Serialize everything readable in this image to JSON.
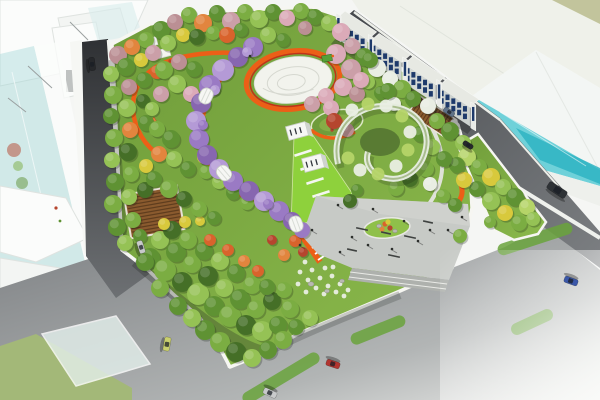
{
  "scene": {
    "type": "aerial-architectural-rendering",
    "subject": "bird's-eye view of an urban pocket-park landscape masterplan with orange loop paths, wisteria tunnel, circular plaza, surrounded by roads and ghost buildings"
  },
  "palette": {
    "bg": "#f5f6f4",
    "ghost_fill": "#fbfcfb",
    "ghost_fill2": "#f3f5f3",
    "ghost_line": "#dfe3e0",
    "ghost_shade": "#eef1ee",
    "teal_slab": "#9fd8da",
    "teal_glass": "#63cdd6",
    "teal_deep": "#2fb4c2",
    "olive": "#bcbf93",
    "roof_slab": "#eff1ea",
    "road_dark1": "#2f3134",
    "road_dark2": "#6d7073",
    "road_ne1": "#44474b",
    "road_ne2": "#7c7f82",
    "road_b1": "#7c7f82",
    "road_b2": "#b2b5b5",
    "road_b3": "#e8e9e7",
    "sidewalk": "#f2f3ef",
    "curb": "#f6f6f2",
    "green_median": "#a3b878",
    "green_strip": "#6aa33c",
    "lawn1": "#6f9c3a",
    "lawn2": "#8cba4c",
    "lawn_bright": "#8ed13c",
    "path_light": "#dfe2d8",
    "orange_path": "#ec5f17",
    "orange_path2": "#f59b3c",
    "red_line": "#c23218",
    "plaza": "#c7cac6",
    "plaza_hi": "#d3d6d2",
    "plaza_step": "#aeb1ad",
    "island_green": "#8fc04a",
    "box_white": "#f6f7f4",
    "box_side": "#cfd3ce",
    "slat_brown": "#8a5a2e",
    "slat_dark": "#5f3d1e",
    "spiral_white": "#e4ebdd",
    "spiral_green": "#a9bd8d",
    "spiral_core": "#4c6b2d",
    "rock": "#b9b9b2",
    "people_ink": "#2b2e2b",
    "win_blue": "#1e3a6b",
    "shop_face": "#d6dad6",
    "shop_face2": "#cdd2cf",
    "tower_face": "#eaece8",
    "shop_roof": "#e7e9e3",
    "g1": "#456f27",
    "g2": "#5f9233",
    "g3": "#7bad42",
    "g4": "#95c255",
    "g5": "#b5d468",
    "pink": "#dbaab8",
    "mauve": "#bb8f94",
    "mauve2": "#cb9fa8",
    "orangeT": "#d9632c",
    "orangeT2": "#e2853e",
    "yellowT": "#d8c93c",
    "redT": "#b5452e",
    "purple": "#9a7ac4",
    "purple2": "#8766b0",
    "purple3": "#b49ad6",
    "wht": "#e9eee3",
    "car_silver": "#c8cacb",
    "car_dark": "#26282b",
    "car_yellow": "#c9cf6d",
    "car_red": "#b23530",
    "car_blue": "#3a57a8",
    "car_blue2": "#5f7288",
    "bus_dark": "#2e3236",
    "kiosk_green": "#57a038"
  },
  "trees": [
    [
      118,
      55,
      9,
      "mauve"
    ],
    [
      132,
      47,
      8,
      "orangeT2"
    ],
    [
      146,
      40,
      8,
      "g3"
    ],
    [
      111,
      74,
      8,
      "g4"
    ],
    [
      126,
      67,
      9,
      "g2"
    ],
    [
      141,
      60,
      7,
      "yellowT"
    ],
    [
      153,
      53,
      8,
      "mauve2"
    ],
    [
      113,
      95,
      9,
      "g3"
    ],
    [
      129,
      87,
      8,
      "mauve"
    ],
    [
      144,
      80,
      8,
      "g2"
    ],
    [
      157,
      72,
      7,
      "orangeT"
    ],
    [
      111,
      116,
      8,
      "g2"
    ],
    [
      127,
      108,
      9,
      "g4"
    ],
    [
      143,
      101,
      7,
      "g1"
    ],
    [
      114,
      138,
      9,
      "g3"
    ],
    [
      130,
      130,
      8,
      "orangeT2"
    ],
    [
      146,
      123,
      8,
      "g2"
    ],
    [
      112,
      160,
      8,
      "g4"
    ],
    [
      128,
      152,
      9,
      "g1"
    ],
    [
      115,
      182,
      9,
      "g2"
    ],
    [
      131,
      174,
      8,
      "g3"
    ],
    [
      146,
      166,
      7,
      "yellowT"
    ],
    [
      113,
      204,
      9,
      "g3"
    ],
    [
      129,
      197,
      8,
      "g4"
    ],
    [
      145,
      190,
      8,
      "g1"
    ],
    [
      117,
      227,
      9,
      "g2"
    ],
    [
      133,
      220,
      8,
      "g3"
    ],
    [
      125,
      243,
      8,
      "g4"
    ],
    [
      140,
      236,
      7,
      "g2"
    ],
    [
      161,
      30,
      9,
      "g2"
    ],
    [
      175,
      22,
      8,
      "mauve"
    ],
    [
      189,
      15,
      8,
      "g3"
    ],
    [
      203,
      23,
      9,
      "orangeT2"
    ],
    [
      217,
      13,
      8,
      "g2"
    ],
    [
      231,
      21,
      9,
      "mauve2"
    ],
    [
      245,
      12,
      8,
      "g3"
    ],
    [
      259,
      19,
      9,
      "g4"
    ],
    [
      273,
      12,
      8,
      "g2"
    ],
    [
      287,
      18,
      8,
      "pink"
    ],
    [
      301,
      11,
      8,
      "g3"
    ],
    [
      315,
      17,
      8,
      "g2"
    ],
    [
      329,
      23,
      8,
      "g4"
    ],
    [
      168,
      43,
      8,
      "g4"
    ],
    [
      183,
      35,
      7,
      "yellowT"
    ],
    [
      197,
      37,
      8,
      "g1"
    ],
    [
      213,
      33,
      7,
      "g3"
    ],
    [
      227,
      35,
      8,
      "orangeT"
    ],
    [
      241,
      30,
      7,
      "g2"
    ],
    [
      305,
      28,
      7,
      "mauve"
    ],
    [
      268,
      35,
      8,
      "g4"
    ],
    [
      283,
      40,
      7,
      "g2"
    ],
    [
      341,
      32,
      9,
      "pink"
    ],
    [
      352,
      46,
      8,
      "mauve2"
    ],
    [
      364,
      57,
      9,
      "g2"
    ],
    [
      377,
      68,
      9,
      "wht"
    ],
    [
      390,
      79,
      8,
      "wht"
    ],
    [
      402,
      89,
      9,
      "g3"
    ],
    [
      413,
      99,
      8,
      "g2"
    ],
    [
      428,
      106,
      8,
      "wht"
    ],
    [
      437,
      121,
      8,
      "g3"
    ],
    [
      450,
      131,
      9,
      "g2"
    ],
    [
      463,
      143,
      8,
      "g4"
    ],
    [
      355,
      70,
      7,
      "g3"
    ],
    [
      368,
      82,
      7,
      "g4"
    ],
    [
      381,
      93,
      7,
      "g2"
    ],
    [
      394,
      104,
      7,
      "wht"
    ],
    [
      467,
      157,
      9,
      "g5"
    ],
    [
      479,
      167,
      8,
      "g3"
    ],
    [
      491,
      177,
      9,
      "yellowT"
    ],
    [
      503,
      187,
      8,
      "g4"
    ],
    [
      515,
      197,
      9,
      "g2"
    ],
    [
      527,
      207,
      8,
      "g5"
    ],
    [
      477,
      189,
      8,
      "g2"
    ],
    [
      491,
      201,
      9,
      "g4"
    ],
    [
      505,
      213,
      8,
      "yellowT"
    ],
    [
      519,
      223,
      8,
      "g3"
    ],
    [
      464,
      180,
      8,
      "yellowT"
    ],
    [
      533,
      219,
      7,
      "g4"
    ],
    [
      457,
      165,
      8,
      "g2"
    ],
    [
      490,
      222,
      6,
      "g3"
    ],
    [
      460,
      236,
      7,
      "g3"
    ],
    [
      150,
      258,
      10,
      "g2"
    ],
    [
      165,
      270,
      11,
      "g3"
    ],
    [
      182,
      282,
      10,
      "g1"
    ],
    [
      198,
      294,
      11,
      "g4"
    ],
    [
      214,
      306,
      10,
      "g2"
    ],
    [
      230,
      316,
      11,
      "g3"
    ],
    [
      246,
      325,
      10,
      "g1"
    ],
    [
      262,
      331,
      10,
      "g4"
    ],
    [
      278,
      325,
      9,
      "g2"
    ],
    [
      290,
      309,
      9,
      "g3"
    ],
    [
      160,
      240,
      9,
      "g4"
    ],
    [
      176,
      252,
      10,
      "g2"
    ],
    [
      192,
      264,
      9,
      "g3"
    ],
    [
      208,
      276,
      10,
      "g1"
    ],
    [
      224,
      288,
      9,
      "g4"
    ],
    [
      240,
      299,
      10,
      "g2"
    ],
    [
      256,
      309,
      9,
      "g3"
    ],
    [
      272,
      301,
      9,
      "g1"
    ],
    [
      284,
      290,
      8,
      "g3"
    ],
    [
      172,
      230,
      9,
      "g1"
    ],
    [
      188,
      240,
      9,
      "g3"
    ],
    [
      204,
      251,
      9,
      "g2"
    ],
    [
      220,
      261,
      9,
      "g4"
    ],
    [
      236,
      273,
      9,
      "g2"
    ],
    [
      252,
      285,
      9,
      "g3"
    ],
    [
      267,
      287,
      8,
      "g2"
    ],
    [
      205,
      330,
      10,
      "g2"
    ],
    [
      220,
      342,
      10,
      "g3"
    ],
    [
      236,
      352,
      10,
      "g1"
    ],
    [
      252,
      358,
      9,
      "g4"
    ],
    [
      268,
      350,
      9,
      "g2"
    ],
    [
      283,
      340,
      9,
      "g3"
    ],
    [
      296,
      327,
      8,
      "g2"
    ],
    [
      310,
      318,
      8,
      "g4"
    ],
    [
      178,
      306,
      9,
      "g2"
    ],
    [
      192,
      318,
      9,
      "g4"
    ],
    [
      160,
      288,
      9,
      "g3"
    ],
    [
      145,
      262,
      9,
      "g2"
    ],
    [
      210,
      240,
      6,
      "orangeT"
    ],
    [
      228,
      250,
      6,
      "orangeT"
    ],
    [
      244,
      261,
      6,
      "orangeT2"
    ],
    [
      258,
      271,
      6,
      "orangeT"
    ],
    [
      284,
      255,
      6,
      "orangeT2"
    ],
    [
      272,
      240,
      5,
      "redT"
    ],
    [
      295,
      241,
      6,
      "orangeT"
    ],
    [
      303,
      252,
      5,
      "redT"
    ],
    [
      185,
      222,
      6,
      "yellowT"
    ],
    [
      164,
      224,
      6,
      "yellowT"
    ],
    [
      200,
      221,
      5,
      "yellowT"
    ],
    [
      164,
      70,
      9,
      "g3"
    ],
    [
      179,
      62,
      8,
      "mauve"
    ],
    [
      194,
      69,
      8,
      "g2"
    ],
    [
      177,
      84,
      9,
      "g4"
    ],
    [
      161,
      94,
      8,
      "mauve2"
    ],
    [
      191,
      94,
      8,
      "pink"
    ],
    [
      152,
      109,
      7,
      "g4"
    ],
    [
      157,
      129,
      8,
      "g3"
    ],
    [
      171,
      139,
      9,
      "g2"
    ],
    [
      159,
      154,
      8,
      "orangeT2"
    ],
    [
      174,
      159,
      8,
      "g4"
    ],
    [
      188,
      169,
      8,
      "g2"
    ],
    [
      204,
      157,
      7,
      "yellowT"
    ],
    [
      154,
      179,
      8,
      "g2"
    ],
    [
      169,
      189,
      9,
      "g3"
    ],
    [
      184,
      199,
      8,
      "g1"
    ],
    [
      199,
      209,
      8,
      "g3"
    ],
    [
      214,
      218,
      7,
      "g2"
    ],
    [
      206,
      172,
      7,
      "g3"
    ],
    [
      219,
      182,
      7,
      "g4"
    ],
    [
      233,
      193,
      7,
      "g2"
    ],
    [
      247,
      203,
      7,
      "g3"
    ],
    [
      336,
      54,
      10,
      "pink"
    ],
    [
      351,
      69,
      10,
      "mauve2"
    ],
    [
      343,
      87,
      9,
      "pink"
    ],
    [
      357,
      94,
      8,
      "mauve"
    ],
    [
      326,
      96,
      8,
      "pink"
    ],
    [
      312,
      104,
      8,
      "mauve2"
    ],
    [
      331,
      108,
      8,
      "pink"
    ],
    [
      334,
      121,
      8,
      "redT"
    ],
    [
      347,
      130,
      7,
      "mauve"
    ],
    [
      361,
      80,
      8,
      "pink"
    ],
    [
      370,
      60,
      8,
      "g2"
    ],
    [
      388,
      91,
      8,
      "g2"
    ],
    [
      420,
      134,
      8,
      "g2"
    ],
    [
      432,
      147,
      8,
      "g4"
    ],
    [
      444,
      159,
      8,
      "g2"
    ],
    [
      426,
      169,
      8,
      "g3"
    ],
    [
      410,
      179,
      8,
      "g1"
    ],
    [
      396,
      188,
      8,
      "g3"
    ],
    [
      430,
      184,
      7,
      "wht"
    ],
    [
      443,
      196,
      7,
      "g3"
    ],
    [
      455,
      205,
      7,
      "g2"
    ],
    [
      350,
      201,
      7,
      "g1"
    ],
    [
      357,
      190,
      6,
      "g2"
    ],
    [
      253,
      47,
      10,
      "purple"
    ],
    [
      238,
      57,
      10,
      "purple2"
    ],
    [
      223,
      70,
      11,
      "purple3"
    ],
    [
      210,
      86,
      11,
      "purple"
    ],
    [
      201,
      103,
      10,
      "purple2"
    ],
    [
      196,
      121,
      10,
      "purple3"
    ],
    [
      199,
      139,
      10,
      "purple"
    ],
    [
      207,
      155,
      10,
      "purple2"
    ],
    [
      219,
      169,
      10,
      "purple3"
    ],
    [
      233,
      181,
      10,
      "purple"
    ],
    [
      249,
      191,
      10,
      "purple2"
    ],
    [
      264,
      201,
      10,
      "purple3"
    ],
    [
      279,
      211,
      10,
      "purple"
    ],
    [
      292,
      221,
      9,
      "purple2"
    ],
    [
      302,
      230,
      8,
      "purple"
    ],
    [
      247,
      52,
      5,
      "purple3"
    ],
    [
      215,
      90,
      5,
      "purple3"
    ],
    [
      203,
      125,
      5,
      "purple"
    ],
    [
      226,
      173,
      5,
      "purple"
    ],
    [
      268,
      204,
      5,
      "purple"
    ],
    [
      295,
      224,
      4,
      "purple3"
    ]
  ],
  "cars": [
    {
      "x": 92,
      "y": 64,
      "a": 83,
      "l": 13,
      "w": 6,
      "c": "car_dark"
    },
    {
      "x": 141,
      "y": 247,
      "a": 72,
      "l": 13,
      "w": 6,
      "c": "car_silver"
    },
    {
      "x": 167,
      "y": 344,
      "a": 100,
      "l": 14,
      "w": 6.5,
      "c": "car_yellow"
    },
    {
      "x": 270,
      "y": 393,
      "a": 205,
      "l": 14,
      "w": 6.5,
      "c": "car_silver"
    },
    {
      "x": 333,
      "y": 364,
      "a": 198,
      "l": 14,
      "w": 6.5,
      "c": "car_red"
    },
    {
      "x": 571,
      "y": 281,
      "a": 200,
      "l": 14,
      "w": 6.5,
      "c": "car_blue"
    },
    {
      "x": 557,
      "y": 190,
      "a": 33,
      "l": 21,
      "w": 8,
      "c": "bus_dark"
    },
    {
      "x": 449,
      "y": 112,
      "a": 33,
      "l": 12,
      "w": 5.5,
      "c": "car_blue2"
    },
    {
      "x": 468,
      "y": 145,
      "a": 33,
      "l": 11,
      "w": 5,
      "c": "car_dark"
    }
  ],
  "people": [
    [
      352,
      238
    ],
    [
      368,
      246
    ],
    [
      392,
      250
    ],
    [
      418,
      242
    ],
    [
      430,
      231
    ],
    [
      404,
      222
    ],
    [
      340,
      253
    ],
    [
      312,
      231
    ],
    [
      250,
      57
    ],
    [
      338,
      206
    ],
    [
      373,
      210
    ],
    [
      448,
      231
    ],
    [
      462,
      218
    ],
    [
      300,
      246
    ]
  ],
  "benches": [
    [
      362,
      229,
      12,
      12
    ],
    [
      386,
      233,
      10,
      12
    ],
    [
      410,
      237,
      12,
      12
    ],
    [
      428,
      222,
      10,
      12
    ],
    [
      352,
      250,
      10,
      12
    ],
    [
      394,
      256,
      12,
      12
    ]
  ],
  "bike_strips": [
    [
      535,
      239,
      78,
      -18
    ],
    [
      378,
      330,
      58,
      -22
    ],
    [
      281,
      378,
      88,
      -31
    ],
    [
      532,
      322,
      45,
      -25
    ]
  ],
  "lawn_bars": [
    [
      303,
      153
    ],
    [
      309,
      167
    ],
    [
      315,
      181
    ],
    [
      321,
      194
    ]
  ],
  "zebra_dashes": [
    [
      309,
      234
    ],
    [
      312,
      240
    ],
    [
      315,
      246
    ],
    [
      318,
      252
    ],
    [
      321,
      258
    ]
  ],
  "flower_dots": [
    [
      330,
      120,
      "orangeT"
    ],
    [
      336,
      118,
      "redT"
    ],
    [
      342,
      121,
      "orangeT2"
    ],
    [
      347,
      124,
      "redT"
    ],
    [
      341,
      127,
      "orangeT"
    ],
    [
      334,
      126,
      "yellowT"
    ],
    [
      328,
      124,
      "orangeT2"
    ],
    [
      339,
      122,
      "redT"
    ],
    [
      345,
      128,
      "orangeT"
    ],
    [
      332,
      130,
      "redT"
    ]
  ],
  "shrub_dots": [
    [
      305,
      262
    ],
    [
      312,
      270
    ],
    [
      320,
      278
    ],
    [
      328,
      286
    ],
    [
      336,
      292
    ],
    [
      344,
      296
    ],
    [
      300,
      272
    ],
    [
      308,
      280
    ],
    [
      316,
      288
    ],
    [
      324,
      294
    ],
    [
      298,
      284
    ],
    [
      306,
      292
    ],
    [
      332,
      276
    ],
    [
      340,
      284
    ],
    [
      348,
      290
    ],
    [
      325,
      268
    ],
    [
      333,
      267
    ]
  ],
  "rocks": [
    [
      311,
      284,
      3
    ],
    [
      327,
      291,
      2.5
    ],
    [
      342,
      281,
      2.5
    ],
    [
      379,
      226,
      2.5
    ],
    [
      395,
      231,
      2.2
    ]
  ],
  "island_plants": [
    [
      385,
      224,
      "orangeT"
    ],
    [
      390,
      228,
      "redT"
    ],
    [
      382,
      229,
      "orangeT2"
    ],
    [
      388,
      222,
      "yellowT"
    ]
  ],
  "glass_specks": [
    [
      14,
      150,
      7,
      "redT"
    ],
    [
      22,
      183,
      6,
      "g2"
    ],
    [
      11,
      214,
      7,
      "redT"
    ],
    [
      25,
      236,
      5,
      "g1"
    ],
    [
      18,
      166,
      5,
      "g3"
    ],
    [
      16,
      228,
      4,
      "redT"
    ]
  ],
  "sketch_lines": [
    [
      28,
      66,
      52,
      88
    ],
    [
      8,
      98,
      26,
      112
    ],
    [
      70,
      22,
      88,
      40
    ],
    [
      96,
      150,
      106,
      170
    ]
  ],
  "shophouses": {
    "start": [
      336,
      38
    ],
    "block_len": 38,
    "pitch": 41,
    "blocks": 4,
    "face_h": 19,
    "win_rows": 2,
    "win_cols": 5
  }
}
